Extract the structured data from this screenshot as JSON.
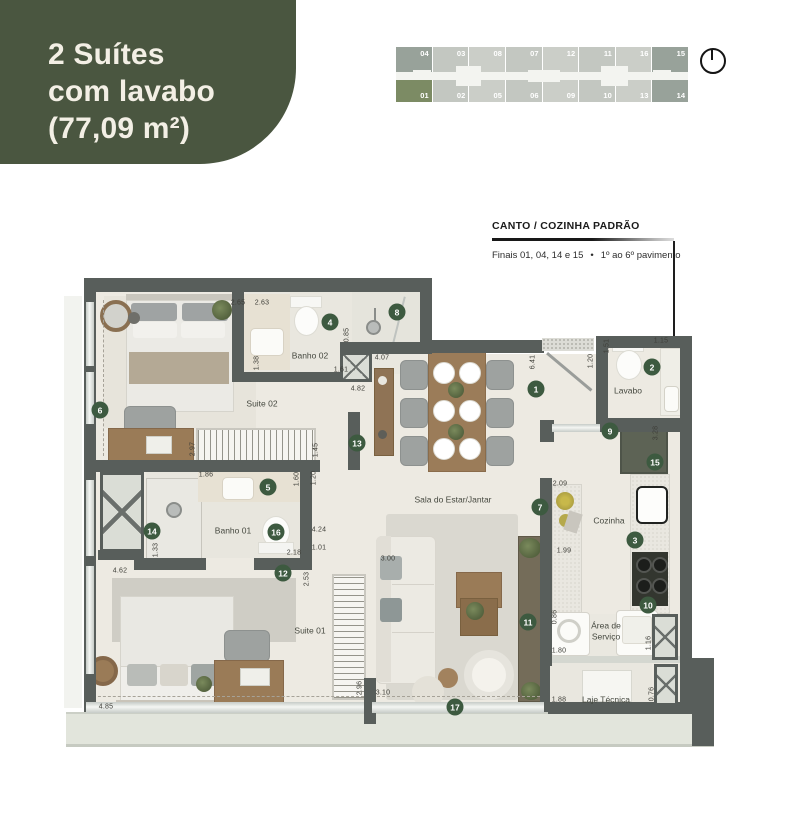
{
  "badge": {
    "line1": "2 Suítes",
    "line2": "com lavabo",
    "line3": "(77,09 m²)",
    "bg": "#4A5640",
    "fg": "#F3EFE5"
  },
  "key_plan": {
    "top_row": [
      "04",
      "03",
      "08",
      "07",
      "12",
      "11",
      "16",
      "15"
    ],
    "bottom_row": [
      "01",
      "02",
      "05",
      "06",
      "09",
      "10",
      "13",
      "14"
    ],
    "highlight_unit": "01",
    "corner_units": [
      "04",
      "15",
      "14"
    ],
    "colors": {
      "cell": "#CBCEC8",
      "cell_alt": "#C3C7C1",
      "corner": "#98A29A",
      "highlight": "#7C8B64"
    }
  },
  "annotation": {
    "title": "CANTO / COZINHA PADRÃO",
    "subtitle_left": "Finais 01, 04, 14 e 15",
    "separator": "•",
    "subtitle_right": "1º ao 6º pavimento"
  },
  "plan": {
    "colors": {
      "wall": "#585E5B",
      "floor": "#EDEAE2",
      "marker": "#3D5A40",
      "balcony": "#E2E5DC"
    },
    "markers": [
      {
        "n": "1",
        "x": 536,
        "y": 389
      },
      {
        "n": "2",
        "x": 652,
        "y": 367
      },
      {
        "n": "3",
        "x": 635,
        "y": 540
      },
      {
        "n": "4",
        "x": 330,
        "y": 322
      },
      {
        "n": "5",
        "x": 268,
        "y": 487
      },
      {
        "n": "6",
        "x": 100,
        "y": 410
      },
      {
        "n": "7",
        "x": 540,
        "y": 507
      },
      {
        "n": "8",
        "x": 397,
        "y": 312
      },
      {
        "n": "9",
        "x": 610,
        "y": 431
      },
      {
        "n": "10",
        "x": 648,
        "y": 605
      },
      {
        "n": "11",
        "x": 528,
        "y": 622
      },
      {
        "n": "12",
        "x": 283,
        "y": 573
      },
      {
        "n": "13",
        "x": 357,
        "y": 443
      },
      {
        "n": "14",
        "x": 152,
        "y": 531
      },
      {
        "n": "15",
        "x": 655,
        "y": 462
      },
      {
        "n": "16",
        "x": 276,
        "y": 532
      },
      {
        "n": "17",
        "x": 455,
        "y": 707
      }
    ],
    "rooms": [
      {
        "label": "Suite 02",
        "x": 262,
        "y": 404
      },
      {
        "label": "Banho 02",
        "x": 310,
        "y": 356
      },
      {
        "label": "Lavabo",
        "x": 628,
        "y": 391
      },
      {
        "label": "Cozinha",
        "x": 609,
        "y": 521
      },
      {
        "label": "Sala do Estar/Jantar",
        "x": 453,
        "y": 500
      },
      {
        "label": "Banho 01",
        "x": 233,
        "y": 531
      },
      {
        "label": "Suite 01",
        "x": 310,
        "y": 631
      },
      {
        "label": "Área de Serviço",
        "x": 606,
        "y": 631,
        "wrap": true
      },
      {
        "label": "Laje Técnica",
        "x": 606,
        "y": 700
      }
    ],
    "dimensions": [
      {
        "t": "2.65",
        "x": 238,
        "y": 303
      },
      {
        "t": "2.63",
        "x": 262,
        "y": 303
      },
      {
        "t": "1.38",
        "x": 257,
        "y": 363,
        "rot": true
      },
      {
        "t": "0.85",
        "x": 347,
        "y": 335,
        "rot": true
      },
      {
        "t": "1.61",
        "x": 341,
        "y": 370
      },
      {
        "t": "4.07",
        "x": 382,
        "y": 358
      },
      {
        "t": "4.82",
        "x": 358,
        "y": 389
      },
      {
        "t": "6.41",
        "x": 533,
        "y": 362,
        "rot": true
      },
      {
        "t": "1.20",
        "x": 591,
        "y": 361,
        "rot": true
      },
      {
        "t": "1.51",
        "x": 607,
        "y": 346,
        "rot": true
      },
      {
        "t": "1.15",
        "x": 661,
        "y": 341
      },
      {
        "t": "3.28",
        "x": 656,
        "y": 433,
        "rot": true
      },
      {
        "t": "2.09",
        "x": 560,
        "y": 484
      },
      {
        "t": "1.99",
        "x": 564,
        "y": 551
      },
      {
        "t": "0.86",
        "x": 555,
        "y": 617,
        "rot": true
      },
      {
        "t": "1.80",
        "x": 559,
        "y": 651
      },
      {
        "t": "1.16",
        "x": 649,
        "y": 643,
        "rot": true
      },
      {
        "t": "1.88",
        "x": 559,
        "y": 700
      },
      {
        "t": "0.76",
        "x": 652,
        "y": 694,
        "rot": true
      },
      {
        "t": "2.97",
        "x": 193,
        "y": 449,
        "rot": true
      },
      {
        "t": "1.45",
        "x": 316,
        "y": 450,
        "rot": true
      },
      {
        "t": "1.60",
        "x": 297,
        "y": 479,
        "rot": true
      },
      {
        "t": "1.20",
        "x": 314,
        "y": 478,
        "rot": true
      },
      {
        "t": "1.86",
        "x": 206,
        "y": 475
      },
      {
        "t": "1.33",
        "x": 156,
        "y": 550,
        "rot": true
      },
      {
        "t": "2.18",
        "x": 294,
        "y": 553
      },
      {
        "t": "4.24",
        "x": 319,
        "y": 530
      },
      {
        "t": "1.01",
        "x": 319,
        "y": 548
      },
      {
        "t": "2.53",
        "x": 307,
        "y": 579,
        "rot": true
      },
      {
        "t": "4.62",
        "x": 120,
        "y": 571
      },
      {
        "t": "3.00",
        "x": 388,
        "y": 559
      },
      {
        "t": "2.96",
        "x": 360,
        "y": 688,
        "rot": true
      },
      {
        "t": "3.10",
        "x": 383,
        "y": 693
      },
      {
        "t": "4.85",
        "x": 106,
        "y": 707
      }
    ]
  }
}
